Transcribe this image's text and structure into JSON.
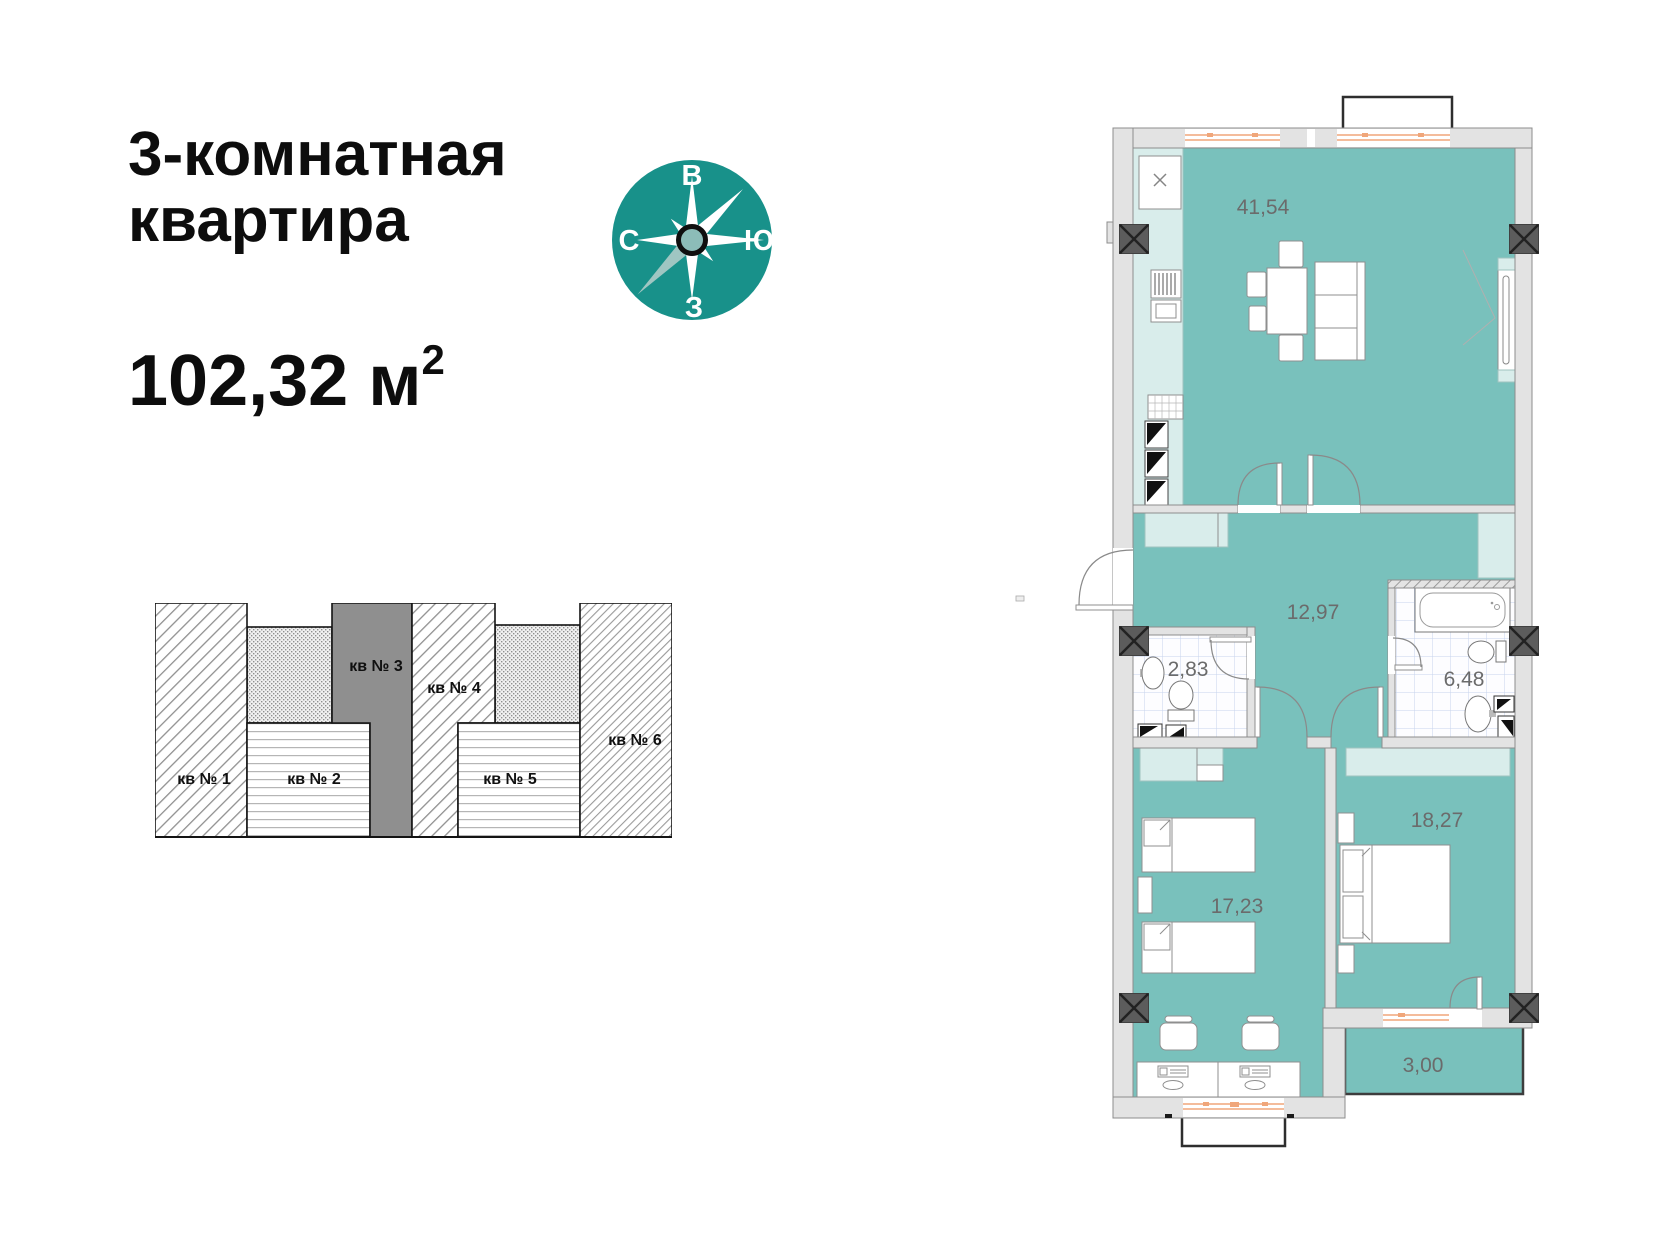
{
  "header": {
    "title_line1": "3-комнатная",
    "title_line2": "квартира",
    "area_value": "102,32 м",
    "area_sup": "2"
  },
  "compass": {
    "top": "В",
    "right": "Ю",
    "bottom": "З",
    "left": "С"
  },
  "building_diagram": {
    "units": [
      {
        "label": "кв № 1"
      },
      {
        "label": "кв № 2"
      },
      {
        "label": "кв № 3"
      },
      {
        "label": "кв № 4"
      },
      {
        "label": "кв № 5"
      },
      {
        "label": "кв № 6"
      }
    ]
  },
  "plan": {
    "area_labels": {
      "living_kitchen": "41,54",
      "hallway": "12,97",
      "wc": "2,83",
      "bathroom": "6,48",
      "bedroom_children": "17,23",
      "bedroom_master": "18,27",
      "balcony": "3,00"
    }
  },
  "colors": {
    "room_fill": "#79c1bc",
    "furniture_light": "#d9edeb",
    "compass_circle": "#18918a",
    "compass_ray_muted": "#9fc6c2",
    "window_orange": "#f0a67a",
    "wall_gray": "#e3e3e3",
    "column_dark": "#5c5c5c",
    "label_gray": "#6b6b6b",
    "unit3_gray": "#8f8f8f"
  }
}
